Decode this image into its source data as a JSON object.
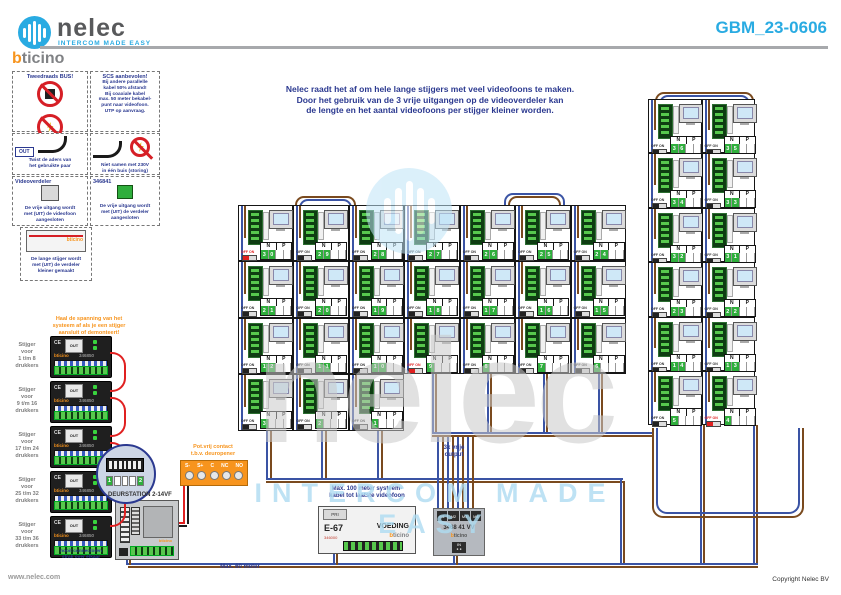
{
  "header": {
    "brand": "nelec",
    "tagline": "INTERCOM MADE EASY",
    "sub_brand_b": "b",
    "sub_brand_rest": "ticino",
    "doc_number": "GBM_23-0606"
  },
  "intro": "Nelec raadt het af om hele lange stijgers met veel videofoons te maken.\nDoor het gebruik van de 3 vrije uitgangen op de videoverdeler kan\nde lengte en het aantal videofoons per stijger kleiner worden.",
  "note_boxes": [
    {
      "title": "Tweedraads BUS!",
      "text": "Bij een aderpaar altijd\nbeide aders van het-\nzelfde paar gebruiken"
    },
    {
      "title": "SCS aanbevolen!",
      "text": "Bij andere parallelle\nkabel 50% afstand!\nBij coaxiale kabel\nmax. 50 meter bekabel-\npunt naar videofoon.\nUTP op aanvraag."
    },
    {
      "title": "Aansluiten",
      "text": "Twist de aders van\nhet gebruikte paar"
    },
    {
      "title": "Let op!",
      "text": "Niet samen met 230V\nin één buis (storing)"
    },
    {
      "title": "Videoverdeler",
      "text": "De vrije uitgang wordt\nmet (UIT) de videofoon\naangesloten"
    },
    {
      "title": "346841",
      "text": "De vrije uitgang wordt\nmet (UIT) de verdeler\naangesloten"
    },
    {
      "title": "",
      "text": "De lange stijger wordt\nmet (UIT) de verdeler\nkleiner gemaakt"
    }
  ],
  "warning_orange": "Haal de spanning van het\nsysteem af als je een stijger\naansluit of demonteert!",
  "risers": [
    {
      "label": "Stijger\nvoor\n1 t/m 8\ndrukkers",
      "model": "346850"
    },
    {
      "label": "Stijger\nvoor\n9 t/m 16\ndrukkers",
      "model": "346850"
    },
    {
      "label": "Stijger\nvoor\n17 t/m 24\ndrukkers",
      "model": "346850"
    },
    {
      "label": "Stijger\nvoor\n25 t/m 32\ndrukkers",
      "model": "346850"
    },
    {
      "label": "Stijger\nvoor\n33 t/m 36\ndrukkers",
      "model": "346850"
    }
  ],
  "riser_stack_caption": "nooit connectoren\nstrak over elkaar",
  "magnifier": {
    "dip_values": [
      "1",
      "",
      "",
      "",
      "2"
    ]
  },
  "door_station": {
    "title": "DEURSTATION 2-14VF",
    "out_label": "OUT",
    "brand": "bticino"
  },
  "contact_box": {
    "title": "Pot.vrij contact\nt.b.v. deuropener",
    "terminals": [
      "S-",
      "S+",
      "C",
      "NC",
      "NO"
    ]
  },
  "psu": {
    "model": "E-67",
    "label": "VOEDING",
    "pri": "PRI",
    "code": "346000",
    "brand_b": "b",
    "brand_rest": "ticino"
  },
  "distributor": {
    "ports": [
      "M1",
      "M2",
      "M3",
      "M4"
    ],
    "model": "3468 41  VV",
    "brand_b": "b",
    "brand_rest": "ticino",
    "in_label": "IN",
    "free_output_label": "3x vrije\noutput"
  },
  "captions": {
    "max100": "Max. 100 meter systeem-\nkabel tot laatste videofoon",
    "max60": "Max. 60 meter"
  },
  "grid": {
    "n_label": "N",
    "p_label": "P",
    "off_on": "OFF ON",
    "main_rows": [
      [
        30,
        29,
        28,
        27,
        26,
        25,
        24
      ],
      [
        21,
        20,
        19,
        18,
        17,
        16,
        15
      ],
      [
        12,
        11,
        10,
        9,
        8,
        7,
        6
      ],
      [
        3,
        2,
        1
      ]
    ],
    "right_rows": [
      [
        36,
        35
      ],
      [
        34,
        33
      ],
      [
        32,
        31
      ],
      [
        23,
        22
      ],
      [
        14,
        13
      ],
      [
        5,
        4
      ]
    ],
    "terminated": [
      30,
      9,
      4
    ]
  },
  "watermark": {
    "word": "nelec",
    "tagline": "INTERCOM MADE EASY"
  },
  "footer": {
    "site": "www.nelec.com",
    "copyright": "Copyright Nelec BV"
  }
}
